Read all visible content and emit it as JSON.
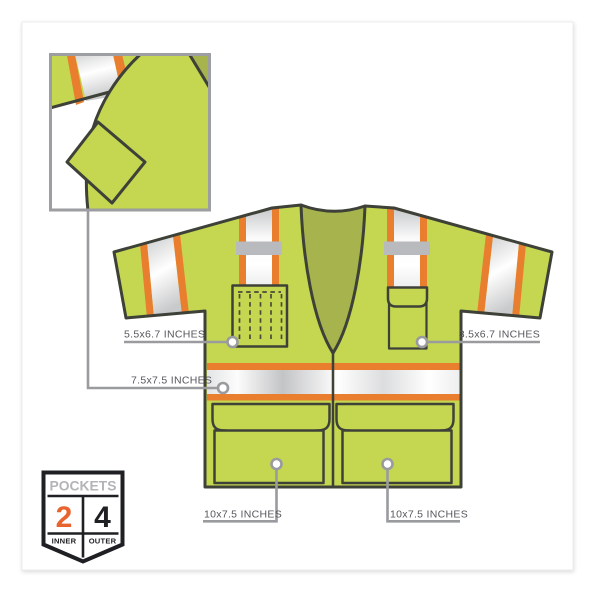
{
  "diagram": {
    "title_hint": "hi-vis safety vest pocket dimensions diagram",
    "annotations": {
      "left_chest_pocket": "5.5x6.7 INCHES",
      "right_chest_pocket": "3.5x6.7 INCHES",
      "inner_pocket": "7.5x7.5 INCHES",
      "left_lower_pocket": "10x7.5 INCHES",
      "right_lower_pocket": "10x7.5 INCHES"
    },
    "badge": {
      "title": "POCKETS",
      "inner_count": "2",
      "outer_count": "4",
      "inner_label": "INNER",
      "outer_label": "OUTER"
    },
    "colors": {
      "vest_lime": "#c5d650",
      "vest_olive": "#a7b34c",
      "stripe_orange": "#e87e2e",
      "outline": "#3e4138",
      "tab_gray": "#b9babd",
      "annotation_gray": "#999b9e",
      "annotation_text": "#55575c",
      "badge_orange": "#e8632d",
      "badge_black": "#1f2023",
      "badge_gray": "#b2b4b6"
    }
  }
}
